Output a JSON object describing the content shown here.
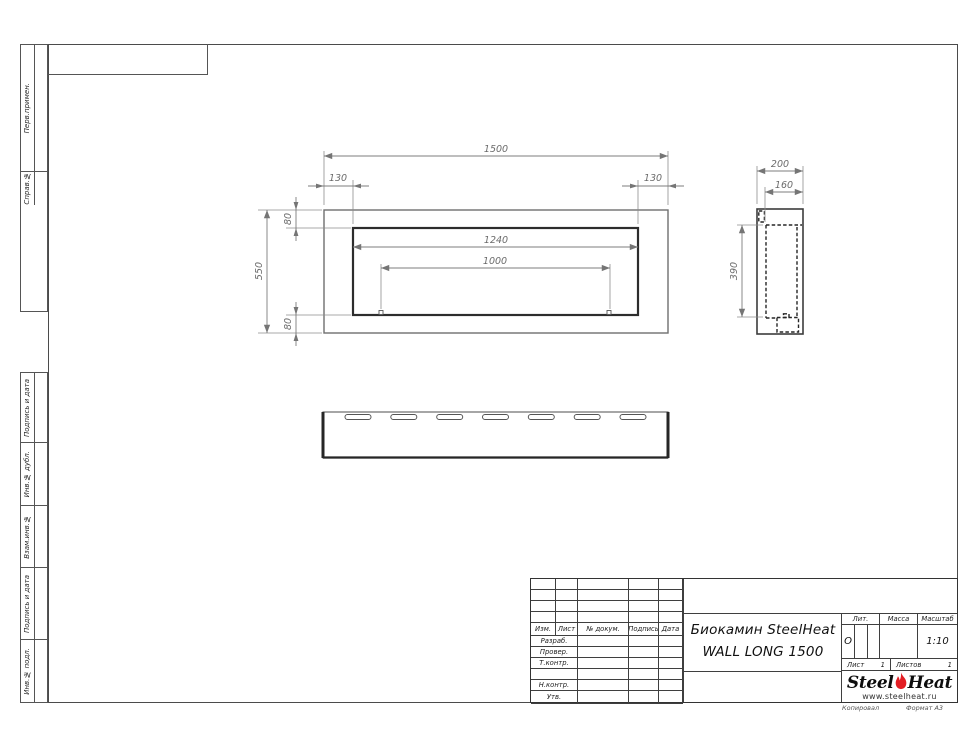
{
  "drawing": {
    "front_view": {
      "dim_total_width": "1500",
      "dim_offset_left": "130",
      "dim_offset_right": "130",
      "dim_top_inset": "80",
      "dim_bottom_inset": "80",
      "dim_height": "550",
      "dim_opening_width": "1240",
      "dim_burner_width": "1000"
    },
    "side_view": {
      "dim_depth": "200",
      "dim_inner_depth": "160",
      "dim_cavity_height": "390"
    },
    "bottom_view": {
      "slot_count": 7
    }
  },
  "margin_columns": {
    "top_cells": [
      {
        "label": "Перв.примен."
      },
      {
        "label": "Справ.№"
      }
    ],
    "bottom_cells": [
      {
        "label": "Подпись и дата"
      },
      {
        "label": "Инв.№ дубл."
      },
      {
        "label": "Взам.инв.№"
      },
      {
        "label": "Подпись и дата"
      },
      {
        "label": "Инв.№ подл."
      }
    ]
  },
  "title_block": {
    "header_cols": [
      "Изм.",
      "Лист",
      "№ докум.",
      "Подпись",
      "Дата"
    ],
    "signature_rows": [
      "Разраб.",
      "Провер.",
      "Т.контр.",
      "",
      "Н.контр.",
      "Утв."
    ],
    "doc_title_line1": "Биокамин SteelHeat",
    "doc_title_line2": "WALL LONG 1500",
    "lit_label": "Лит.",
    "lit_value": "О",
    "mass_label": "Масса",
    "scale_label": "Масштаб",
    "scale_value": "1:10",
    "sheet_label": "Лист",
    "sheet_value": "1",
    "sheets_label": "Листов",
    "sheets_value": "1",
    "logo": {
      "part1": "Steel",
      "part2": "Heat",
      "url": "www.steelheat.ru",
      "flame_color": "#e31e24"
    }
  },
  "footer": {
    "copied_label": "Копировал",
    "format_label": "Формат А3"
  }
}
